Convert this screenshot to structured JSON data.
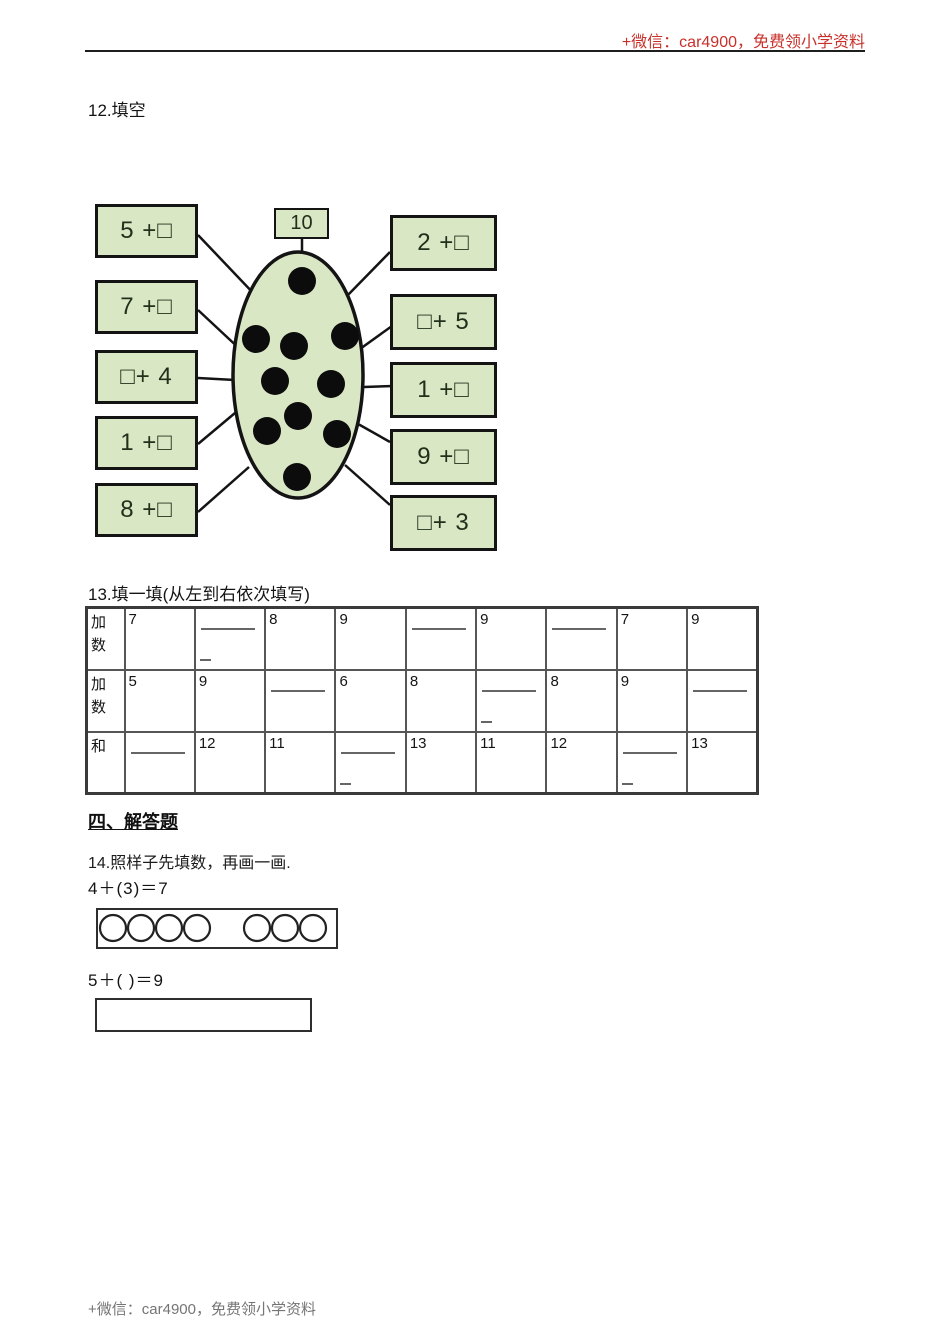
{
  "page": {
    "header_note": "+微信：car4900，免费领小学资料",
    "footer_note": "+微信：car4900，免费领小学资料",
    "accent_color": "#c8312b",
    "box_fill_color": "#dae7c5"
  },
  "q12": {
    "label": "12.填空",
    "diagram": {
      "sum_label": "10",
      "dot_count": 10,
      "left_boxes": [
        "5 +□",
        "7 +□",
        "□+ 4",
        "1 +□",
        "8 +□"
      ],
      "right_boxes": [
        "2 +□",
        "□+ 5",
        "1 +□",
        "9 +□",
        "□+ 3"
      ],
      "dots": [
        [
          217,
          86
        ],
        [
          171,
          144
        ],
        [
          209,
          151
        ],
        [
          260,
          141
        ],
        [
          190,
          186
        ],
        [
          246,
          189
        ],
        [
          213,
          221
        ],
        [
          182,
          236
        ],
        [
          252,
          239
        ],
        [
          212,
          282
        ]
      ],
      "lines": [
        [
          113,
          40,
          172,
          102
        ],
        [
          113,
          115,
          158,
          157
        ],
        [
          113,
          183,
          150,
          185
        ],
        [
          113,
          249,
          150,
          218
        ],
        [
          113,
          317,
          164,
          272
        ],
        [
          217,
          43,
          217,
          58
        ],
        [
          305,
          57,
          260,
          103
        ],
        [
          307,
          131,
          268,
          159
        ],
        [
          309,
          191,
          279,
          192
        ],
        [
          305,
          247,
          266,
          225
        ],
        [
          305,
          310,
          260,
          270
        ]
      ]
    }
  },
  "q13": {
    "label": "13.填一填(从左到右依次填写)",
    "table": {
      "row_headers": [
        "加数",
        "加数",
        "和"
      ],
      "rows": [
        [
          {
            "v": "7"
          },
          {
            "b": 2
          },
          {
            "v": "8"
          },
          {
            "v": "9"
          },
          {
            "b": 1
          },
          {
            "v": "9"
          },
          {
            "b": 1
          },
          {
            "v": "7"
          },
          {
            "v": "9"
          }
        ],
        [
          {
            "v": "5"
          },
          {
            "v": "9"
          },
          {
            "b": 1
          },
          {
            "v": "6"
          },
          {
            "v": "8"
          },
          {
            "b": 2
          },
          {
            "v": "8"
          },
          {
            "v": "9"
          },
          {
            "b": 1
          }
        ],
        [
          {
            "b": 1
          },
          {
            "v": "12"
          },
          {
            "v": "11"
          },
          {
            "b": 2
          },
          {
            "v": "13"
          },
          {
            "v": "11"
          },
          {
            "v": "12"
          },
          {
            "b": 2
          },
          {
            "v": "13"
          }
        ]
      ]
    }
  },
  "section4": {
    "title": "四、解答题"
  },
  "q14": {
    "label": "14.照样子先填数，再画一画.",
    "example_equation": "4＋(3)＝7",
    "example_circle_groups": [
      4,
      3
    ],
    "second_equation": "5＋( )＝9"
  }
}
